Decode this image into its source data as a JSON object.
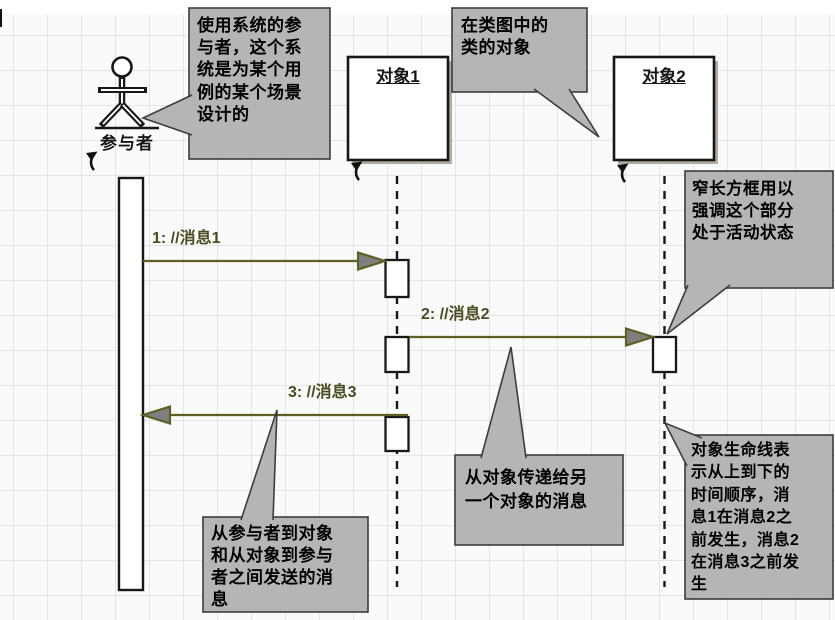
{
  "diagram": {
    "title_hint": "UML sequence diagram with annotations",
    "actor": {
      "label": "参与者"
    },
    "objects": [
      {
        "title": "对象1"
      },
      {
        "title": "对象2"
      }
    ],
    "messages": [
      {
        "label": "1: //消息1"
      },
      {
        "label": "2: //消息2"
      },
      {
        "label": "3: //消息3"
      }
    ],
    "callouts": [
      {
        "id": "actor-note",
        "text": "使用系统的参\n与者，这个系\n统是为某个用\n例的某个场景\n设计的"
      },
      {
        "id": "object-note",
        "text": "在类图中的\n类的对象"
      },
      {
        "id": "activation-note",
        "text": "窄长方框用以\n强调这个部分\n处于活动状态"
      },
      {
        "id": "lifeline-note",
        "text": "对象生命线表\n示从上到下的\n时间顺序，消\n息1在消息2之\n前发生，消息2\n在消息3之前发\n生"
      },
      {
        "id": "object-message-note",
        "text": "从对象传递给另\n一个对象的消息"
      },
      {
        "id": "actor-message-note",
        "text": "从参与者到对象\n和从对象到参与\n者之间发送的消\n息"
      }
    ],
    "icons": [
      {
        "name": "shape-anchor-arrow-icon",
        "count": 3
      }
    ],
    "colors": {
      "grid_bg": "#fafafa",
      "grid_line": "#e4e4e7",
      "shape_border": "#171717",
      "box_shadow": "#b2ac9c",
      "callout_fill": "#b5b5b5",
      "callout_border": "#3d3d3d",
      "message_line": "#5f5f23",
      "arrowhead_fill": "#7f7f7f",
      "message_text": "#4c4c21"
    }
  }
}
